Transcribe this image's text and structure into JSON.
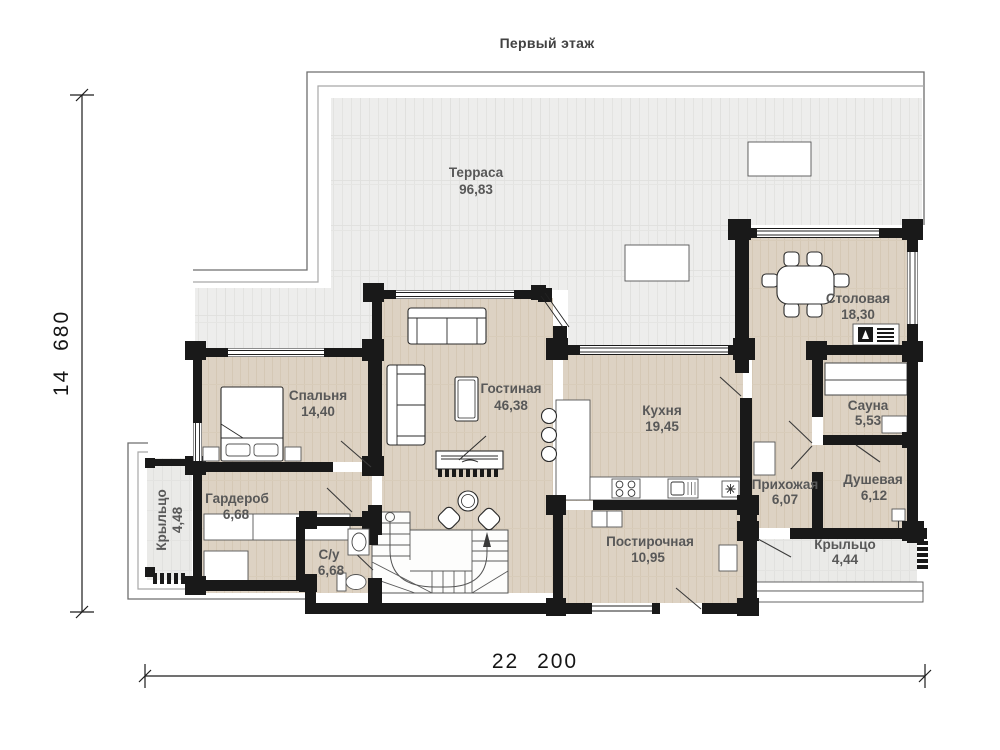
{
  "title": "Первый этаж",
  "rooms": [
    {
      "id": "terrace",
      "name": "Терраса",
      "area": "96,83"
    },
    {
      "id": "dining",
      "name": "Столовая",
      "area": "18,30"
    },
    {
      "id": "bedroom",
      "name": "Спальня",
      "area": "14,40"
    },
    {
      "id": "living",
      "name": "Гостиная",
      "area": "46,38"
    },
    {
      "id": "kitchen",
      "name": "Кухня",
      "area": "19,45"
    },
    {
      "id": "sauna",
      "name": "Сауна",
      "area": "5,53"
    },
    {
      "id": "shower",
      "name": "Душевая",
      "area": "6,12"
    },
    {
      "id": "hallway",
      "name": "Прихожая",
      "area": "6,07"
    },
    {
      "id": "wardrobe",
      "name": "Гардероб",
      "area": "6,68"
    },
    {
      "id": "wc",
      "name": "С/у",
      "area": "6,68"
    },
    {
      "id": "laundry",
      "name": "Постирочная",
      "area": "10,95"
    },
    {
      "id": "porch_left",
      "name": "Крыльцо",
      "area": "4,48"
    },
    {
      "id": "porch_right",
      "name": "Крыльцо",
      "area": "4,44"
    }
  ],
  "dimensions": {
    "horizontal": "22 200",
    "vertical": "14 680"
  },
  "colors": {
    "wall": "#191919",
    "floor": "#ddd2c3",
    "terrace": "#ededec",
    "porch": "#eaeae8",
    "label": "#585858"
  }
}
